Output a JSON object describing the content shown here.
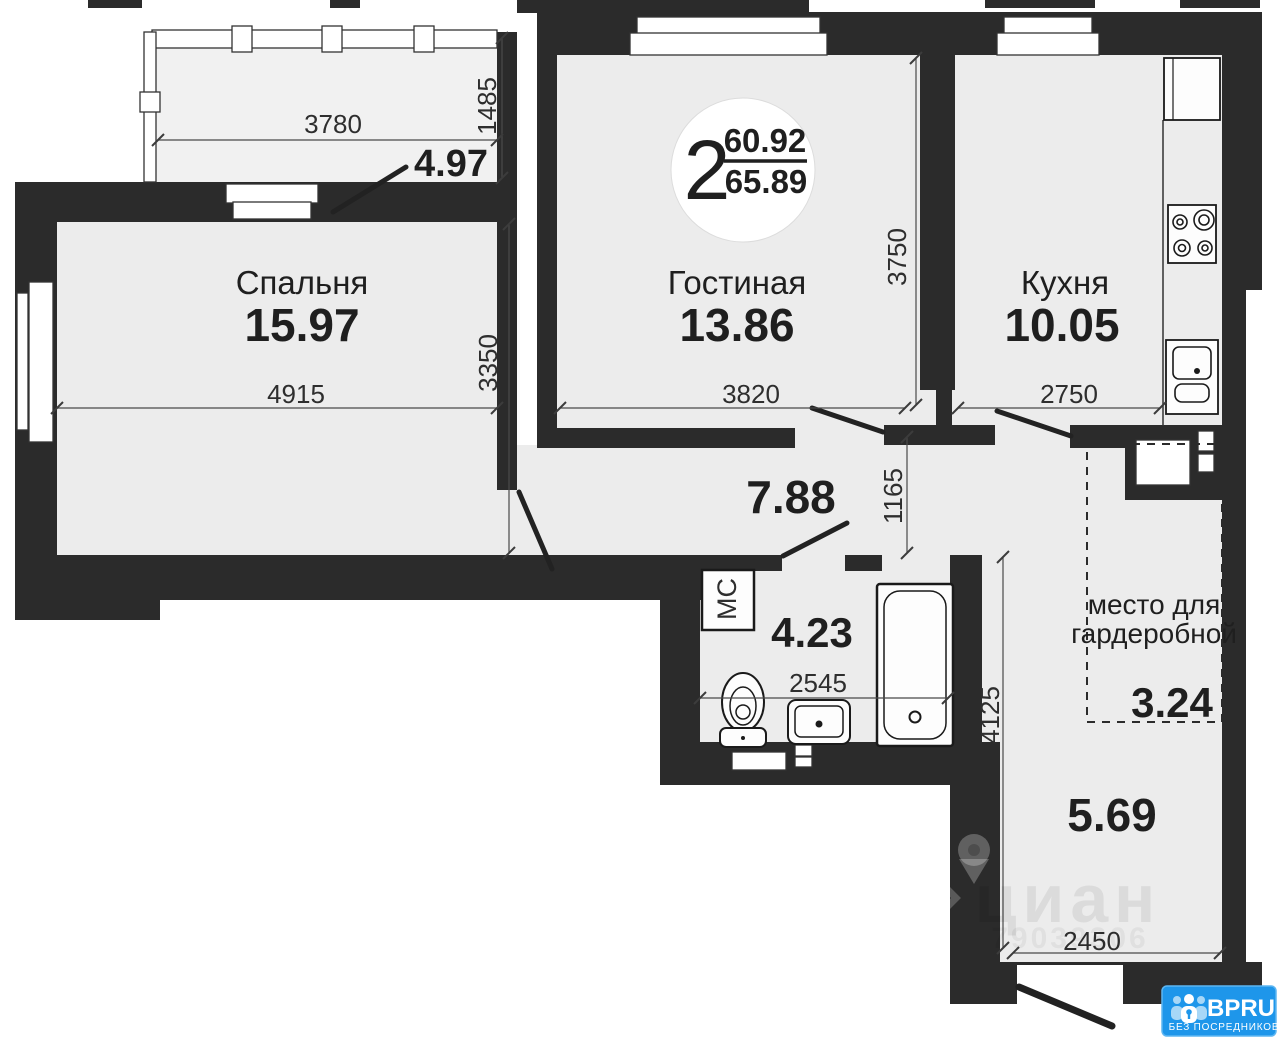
{
  "plan": {
    "badge": {
      "rooms": "2",
      "area_living": "60.92",
      "area_total": "65.89"
    },
    "balcony": {
      "area": "4.97",
      "dim_width": "3780",
      "dim_depth": "1485"
    },
    "bedroom": {
      "name": "Спальня",
      "area": "15.97",
      "dim_width": "4915",
      "dim_depth": "3350"
    },
    "living_room": {
      "name": "Гостиная",
      "area": "13.86",
      "dim_width": "3820",
      "dim_depth": "3750"
    },
    "kitchen": {
      "name": "Кухня",
      "area": "10.05",
      "dim_width": "2750"
    },
    "hallway": {
      "area": "7.88",
      "dim_depth": "1165"
    },
    "bathroom": {
      "label": "МС",
      "area": "4.23",
      "dim_width": "2545"
    },
    "wardrobe": {
      "label_line1": "место для",
      "label_line2": "гардеробной",
      "area": "3.24"
    },
    "entrance_hall": {
      "area": "5.69",
      "dim_depth": "4125",
      "dim_width": "2450"
    }
  },
  "watermark": {
    "brand": "циан",
    "id": "79039306"
  },
  "logo": {
    "brand": "BPRU",
    "tagline": "БЕЗ ПОСРЕДНИКОВ"
  },
  "colors": {
    "wall": "#2b2b2b",
    "room_fill": "#ececec",
    "balcony_fill": "#f1f1f1",
    "logo_blue": "#1e96ea"
  }
}
